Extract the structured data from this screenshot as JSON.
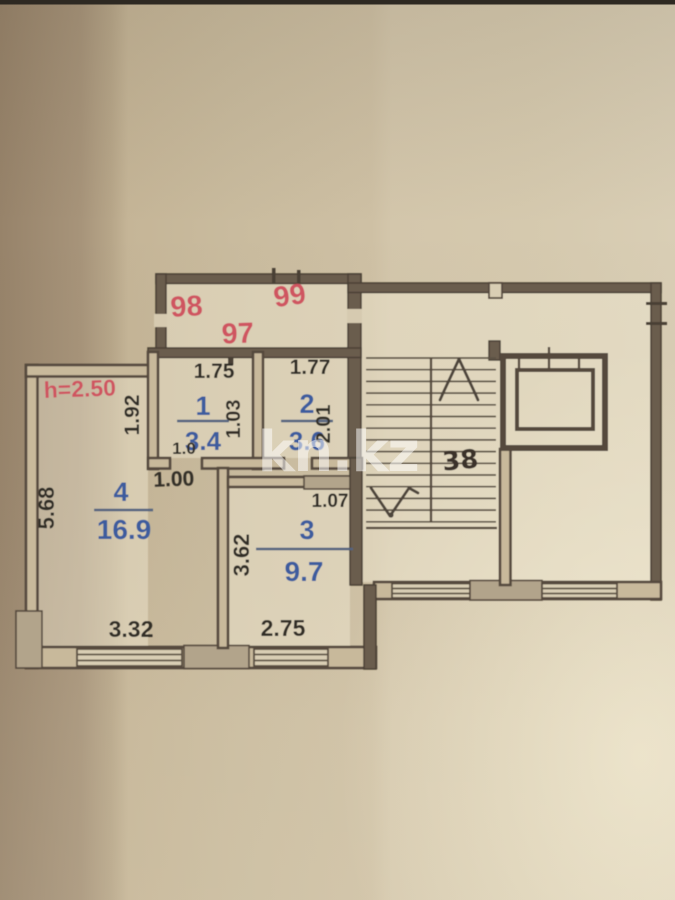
{
  "watermark": {
    "text": "kn.kz"
  },
  "colors": {
    "paper": "#cfc2a5",
    "ink": "#55493c",
    "red_label": "#cf5560",
    "blue_label": "#3d5c9e",
    "wall_highlight": "#b2a48b"
  },
  "plan": {
    "height_label": "h=2.50",
    "units": {
      "u97": "97",
      "u98": "98",
      "u99": "99"
    },
    "stair_flight_label": "38",
    "rooms": {
      "r1": {
        "number": "1",
        "area": "3.4"
      },
      "r2": {
        "number": "2",
        "area": "3.6"
      },
      "r3": {
        "number": "3",
        "area": "9.7"
      },
      "r4": {
        "number": "4",
        "area": "16.9"
      }
    },
    "dims": {
      "r1_width": "1.75",
      "r2_width": "1.77",
      "r1_depth": "1.03",
      "r2_depth": "2.01",
      "r1_door": "1.0",
      "hall_door": "1.00",
      "r4_upper_depth": "1.92",
      "r4_depth": "5.68",
      "r3_door": "1.07",
      "r3_depth": "3.62",
      "r3_width": "2.75",
      "r4_width": "3.32"
    }
  }
}
